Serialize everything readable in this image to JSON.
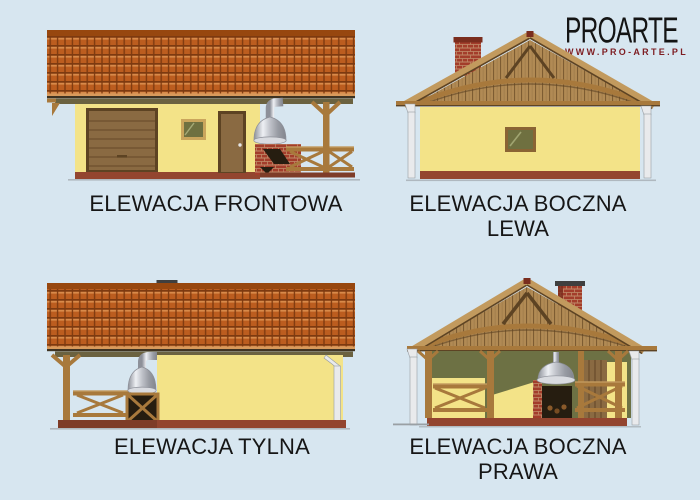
{
  "logo": {
    "brand": "PROARTE",
    "url": "WWW.PRO-ARTE.PL"
  },
  "elevations": [
    {
      "id": "frontowa",
      "label": "ELEWACJA FRONTOWA",
      "lines": [
        "ELEWACJA FRONTOWA"
      ]
    },
    {
      "id": "boczna-lewa",
      "label": "ELEWACJA BOCZNA LEWA",
      "lines": [
        "ELEWACJA BOCZNA",
        "LEWA"
      ]
    },
    {
      "id": "tylna",
      "label": "ELEWACJA TYLNA",
      "lines": [
        "ELEWACJA TYLNA"
      ]
    },
    {
      "id": "boczna-prawa",
      "label": "ELEWACJA BOCZNA PRAWA",
      "lines": [
        "ELEWACJA BOCZNA",
        "PRAWA"
      ]
    }
  ],
  "palette": {
    "bg": "#d7e6f0",
    "ink": "#161616",
    "logoInk": "#141414",
    "logoRed": "#7e1d22",
    "roofTile": "#bc5d1f",
    "roofTileDark": "#7d3a10",
    "roofTileHi": "#d88a4a",
    "roofRidge": "#97470f",
    "roofEdgeLight": "#d89a5c",
    "fascia": "#3f3322",
    "eaveBand": "#6b6240",
    "wall": "#f3e388",
    "plinth": "#93452f",
    "plinthDark": "#7e3c28",
    "woodDark": "#5d4323",
    "door": "#8a6a42",
    "doorLine": "#654828",
    "woodMid": "#a8793c",
    "woodHi": "#c29a5e",
    "plank": "#b18a54",
    "plankLine": "#7d5c32",
    "brick": "#a33d2b",
    "mortar": "#c08a68",
    "interior": "#6d7144",
    "glass": "#6f7040",
    "glassFrame": "#8a6434",
    "winFrameLight": "#caa55c",
    "metalLight": "#eef0f4",
    "metalDark": "#8d9099",
    "spout": "#e9eaec",
    "deck": "#6a4a28",
    "dark": "#261d10",
    "ground": "#9aa0a4",
    "chimneyCap": "#3f3f3f",
    "capRed": "#7a2d1e"
  }
}
